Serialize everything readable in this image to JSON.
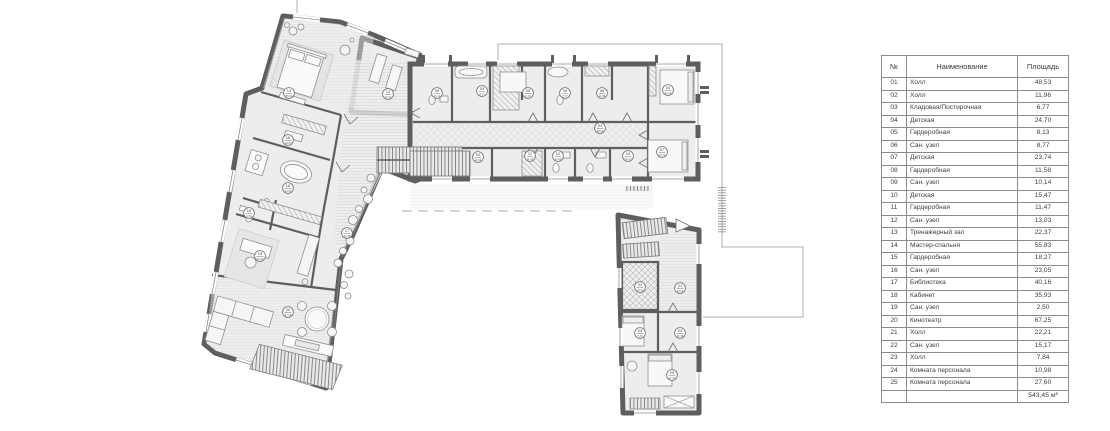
{
  "colors": {
    "wall": "#5e5e5e",
    "floor": "#ededed",
    "thin_line": "#9a9a9a",
    "paper": "#ffffff"
  },
  "legend_table": {
    "headers": {
      "num": "№",
      "name": "Наименование",
      "area": "Площадь"
    },
    "rows": [
      {
        "num": "01",
        "name": "Холл",
        "area": "48,53"
      },
      {
        "num": "02",
        "name": "Холл",
        "area": "11,96"
      },
      {
        "num": "03",
        "name": "Кладовая/Постирочная",
        "area": "6,77"
      },
      {
        "num": "04",
        "name": "Детская",
        "area": "24,70"
      },
      {
        "num": "05",
        "name": "Гардеробная",
        "area": "8,13"
      },
      {
        "num": "06",
        "name": "Сан. узел",
        "area": "8,77"
      },
      {
        "num": "07",
        "name": "Детская",
        "area": "23,74"
      },
      {
        "num": "08",
        "name": "Гардеробная",
        "area": "11,58"
      },
      {
        "num": "09",
        "name": "Сан. узел",
        "area": "10,14"
      },
      {
        "num": "10",
        "name": "Детская",
        "area": "15,47"
      },
      {
        "num": "11",
        "name": "Гардеробная",
        "area": "11,47"
      },
      {
        "num": "12",
        "name": "Сан. узел",
        "area": "13,03"
      },
      {
        "num": "13",
        "name": "Тренажерный зал",
        "area": "22,37"
      },
      {
        "num": "14",
        "name": "Мастер-спальня",
        "area": "55,83"
      },
      {
        "num": "15",
        "name": "Гардеробная",
        "area": "18,27"
      },
      {
        "num": "16",
        "name": "Сан. узел",
        "area": "23,05"
      },
      {
        "num": "17",
        "name": "Библиотека",
        "area": "40,16"
      },
      {
        "num": "18",
        "name": "Кабинет",
        "area": "35,93"
      },
      {
        "num": "19",
        "name": "Сан. узел",
        "area": "2,50"
      },
      {
        "num": "20",
        "name": "Кинотеатр",
        "area": "67,25"
      },
      {
        "num": "21",
        "name": "Холл",
        "area": "22,21"
      },
      {
        "num": "22",
        "name": "Сан. узел",
        "area": "15,17"
      },
      {
        "num": "23",
        "name": "Холл",
        "area": "7,84"
      },
      {
        "num": "24",
        "name": "Комната персонала",
        "area": "10,98"
      },
      {
        "num": "25",
        "name": "Комната персонала",
        "area": "27,60"
      }
    ],
    "total": "543,45 м²"
  },
  "plan": {
    "room_labels": [
      {
        "num": "01",
        "area": "48,53",
        "x": 600,
        "y": 128
      },
      {
        "num": "02",
        "area": "11,96",
        "x": 478,
        "y": 157
      },
      {
        "num": "03",
        "area": "6,77",
        "x": 482,
        "y": 91
      },
      {
        "num": "04",
        "area": "24,70",
        "x": 668,
        "y": 90
      },
      {
        "num": "05",
        "area": "8,13",
        "x": 528,
        "y": 93
      },
      {
        "num": "06",
        "area": "8,77",
        "x": 565,
        "y": 93
      },
      {
        "num": "07",
        "area": "23,74",
        "x": 662,
        "y": 152
      },
      {
        "num": "08",
        "area": "11,58",
        "x": 602,
        "y": 93
      },
      {
        "num": "09",
        "area": "10,14",
        "x": 437,
        "y": 93
      },
      {
        "num": "10",
        "area": "15,47",
        "x": 628,
        "y": 156
      },
      {
        "num": "11",
        "area": "11,47",
        "x": 530,
        "y": 156
      },
      {
        "num": "12",
        "area": "13,03",
        "x": 558,
        "y": 156
      },
      {
        "num": "13",
        "area": "22,37",
        "x": 388,
        "y": 94
      },
      {
        "num": "14",
        "area": "55,83",
        "x": 289,
        "y": 93
      },
      {
        "num": "15",
        "area": "18,27",
        "x": 288,
        "y": 140
      },
      {
        "num": "16",
        "area": "23,05",
        "x": 288,
        "y": 188
      },
      {
        "num": "17",
        "area": "40,16",
        "x": 347,
        "y": 233
      },
      {
        "num": "18",
        "area": "35,93",
        "x": 260,
        "y": 256
      },
      {
        "num": "19",
        "area": "2,50",
        "x": 249,
        "y": 213
      },
      {
        "num": "20",
        "area": "67,25",
        "x": 288,
        "y": 312
      },
      {
        "num": "21",
        "area": "22,21",
        "x": 680,
        "y": 288
      },
      {
        "num": "22",
        "area": "15,17",
        "x": 640,
        "y": 287
      },
      {
        "num": "23",
        "area": "7,84",
        "x": 640,
        "y": 333
      },
      {
        "num": "24",
        "area": "10,98",
        "x": 680,
        "y": 333
      },
      {
        "num": "25",
        "area": "27,60",
        "x": 672,
        "y": 375
      }
    ]
  }
}
